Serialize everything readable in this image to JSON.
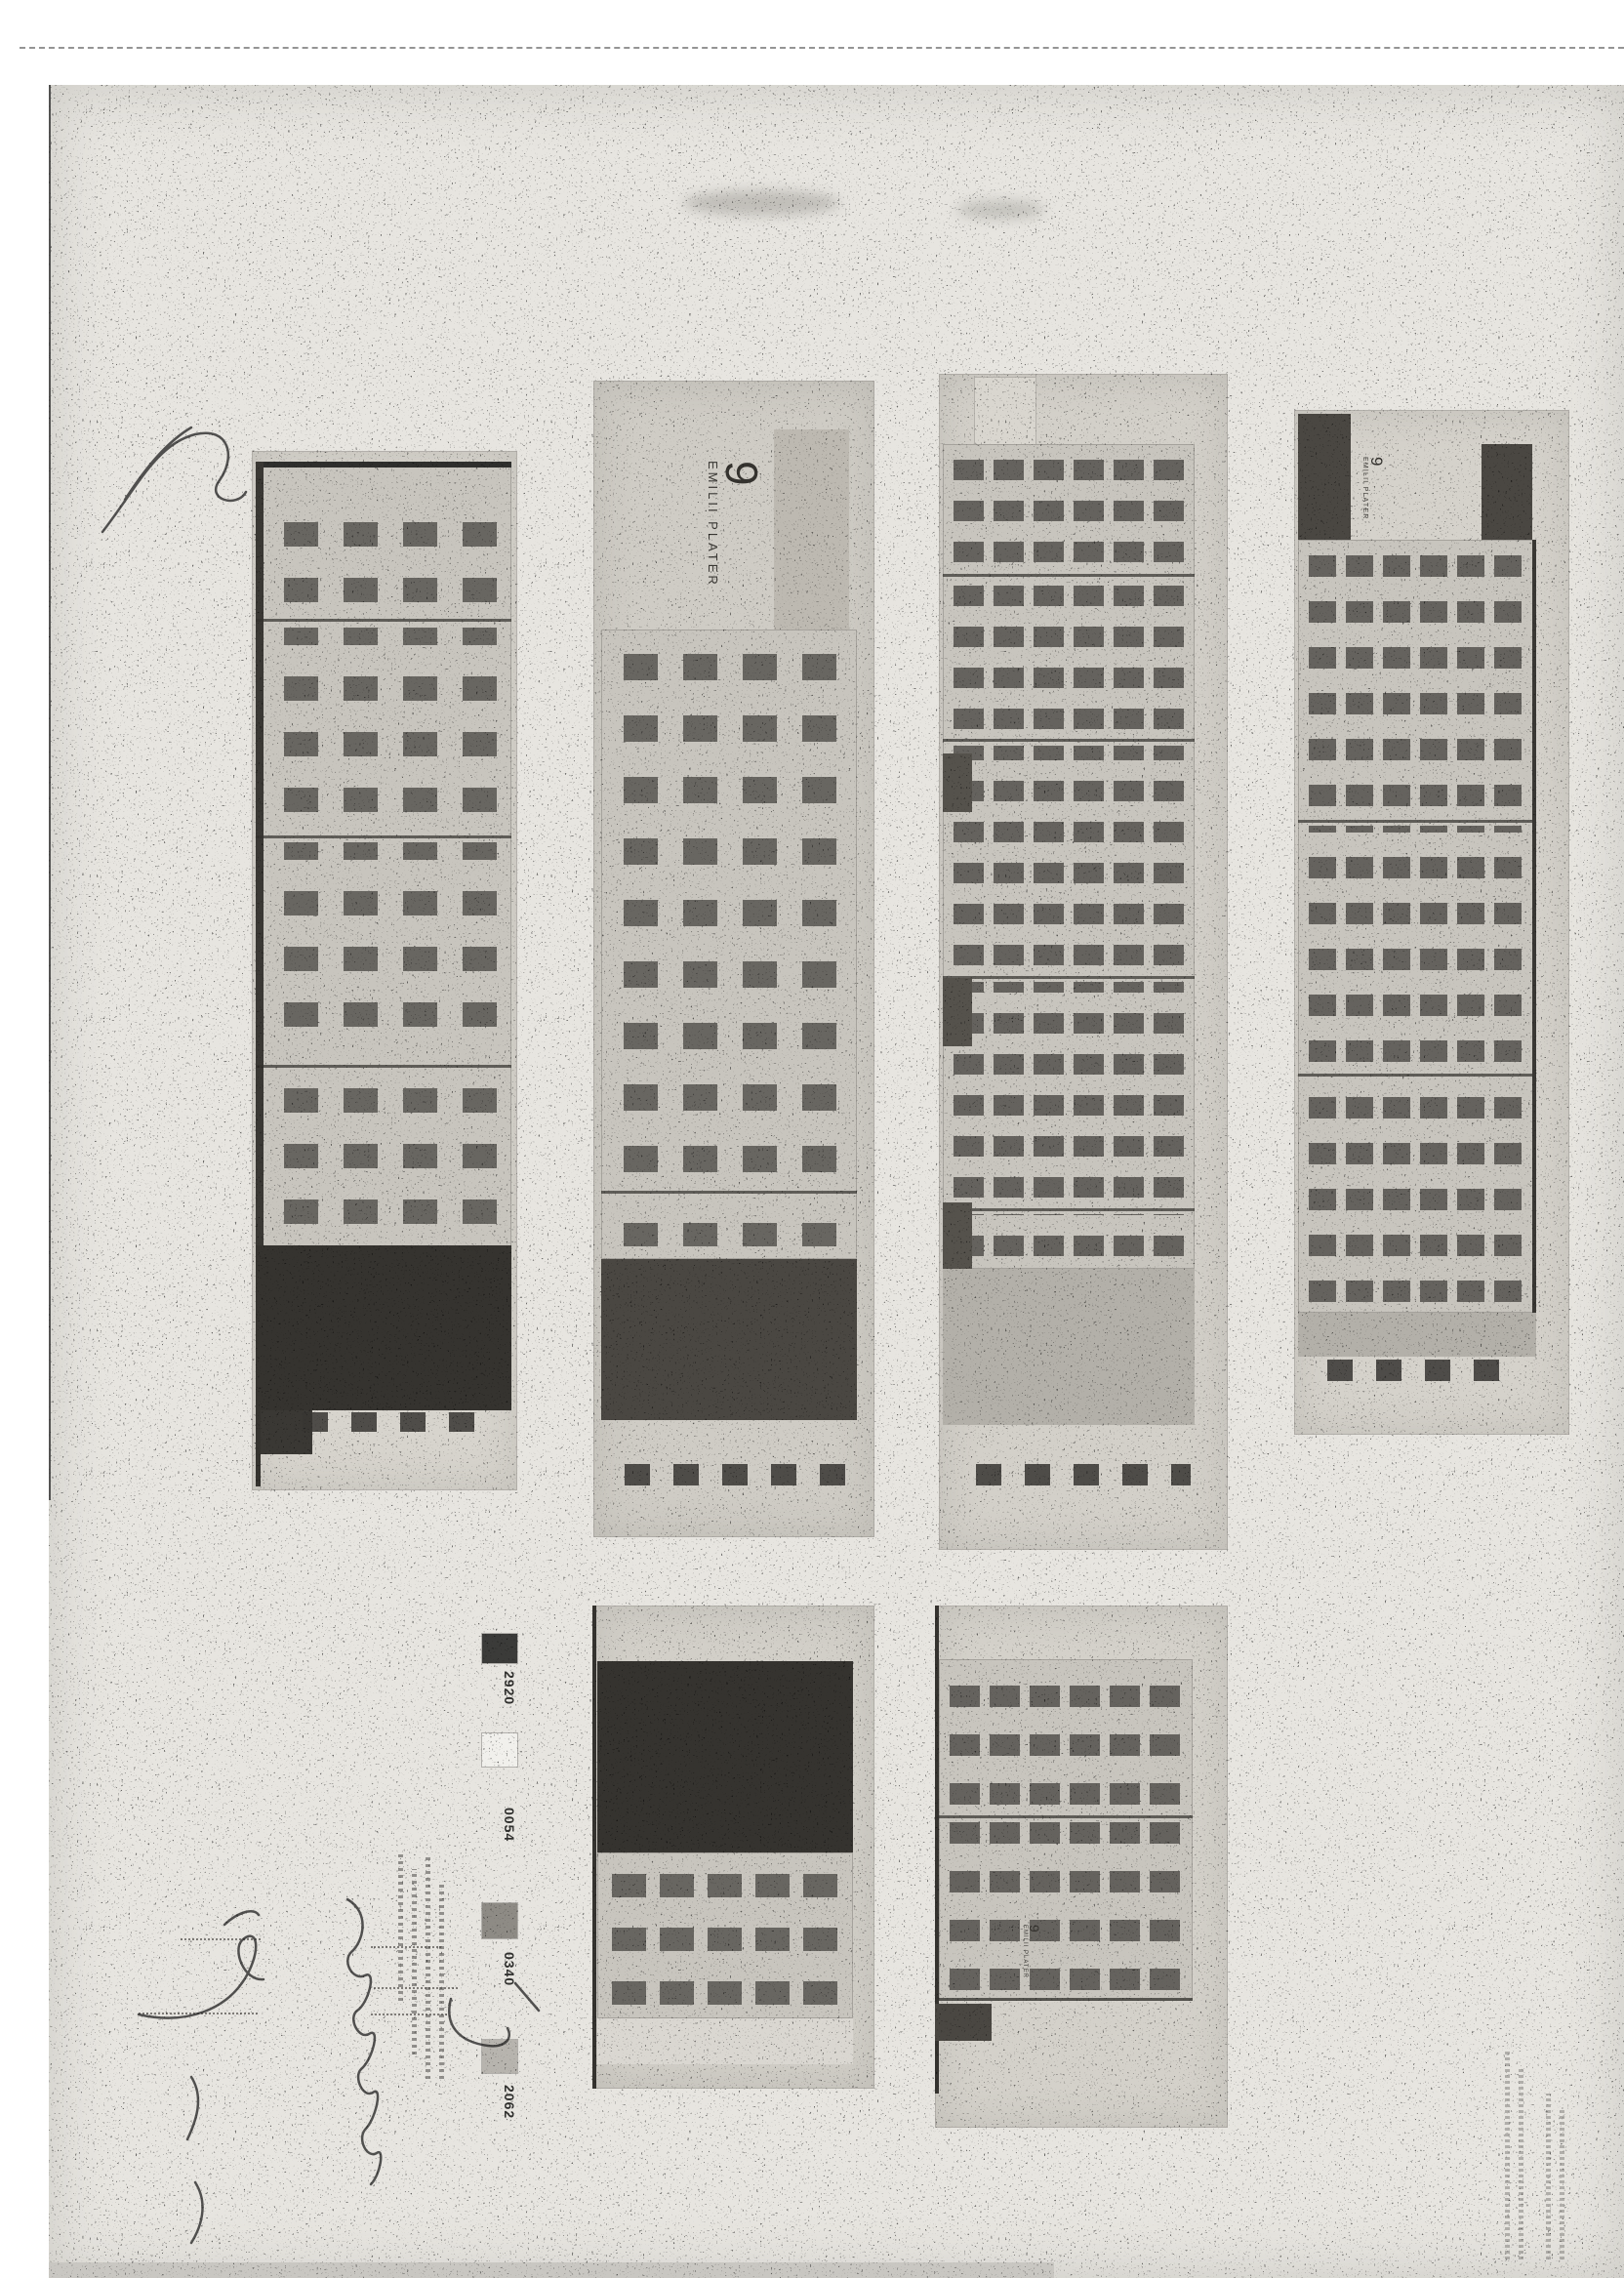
{
  "address": {
    "number": "9",
    "name": "EMILII PLATER"
  },
  "legend": {
    "items": [
      {
        "code": "2920",
        "swatch": "#3b3b39"
      },
      {
        "code": "0054",
        "swatch": "#f1f0ec"
      },
      {
        "code": "0340",
        "swatch": "#8e8b85"
      },
      {
        "code": "2062",
        "swatch": "#b7b4ae"
      }
    ]
  },
  "palette": {
    "sheet": "#e7e5e0",
    "photo_a": "#d7d4cd",
    "photo_b": "#cfccc5",
    "photo_c": "#d3d0c9",
    "photo_d": "#d5d2cb",
    "photo_b2": "#d2cfc8",
    "photo_c2": "#d4d1ca",
    "face": "#c8c5be",
    "dark_band": "#35332f",
    "mid_band": "#4a4742",
    "light_band": "#b3b0a9",
    "ink": "#2b2b2b"
  }
}
